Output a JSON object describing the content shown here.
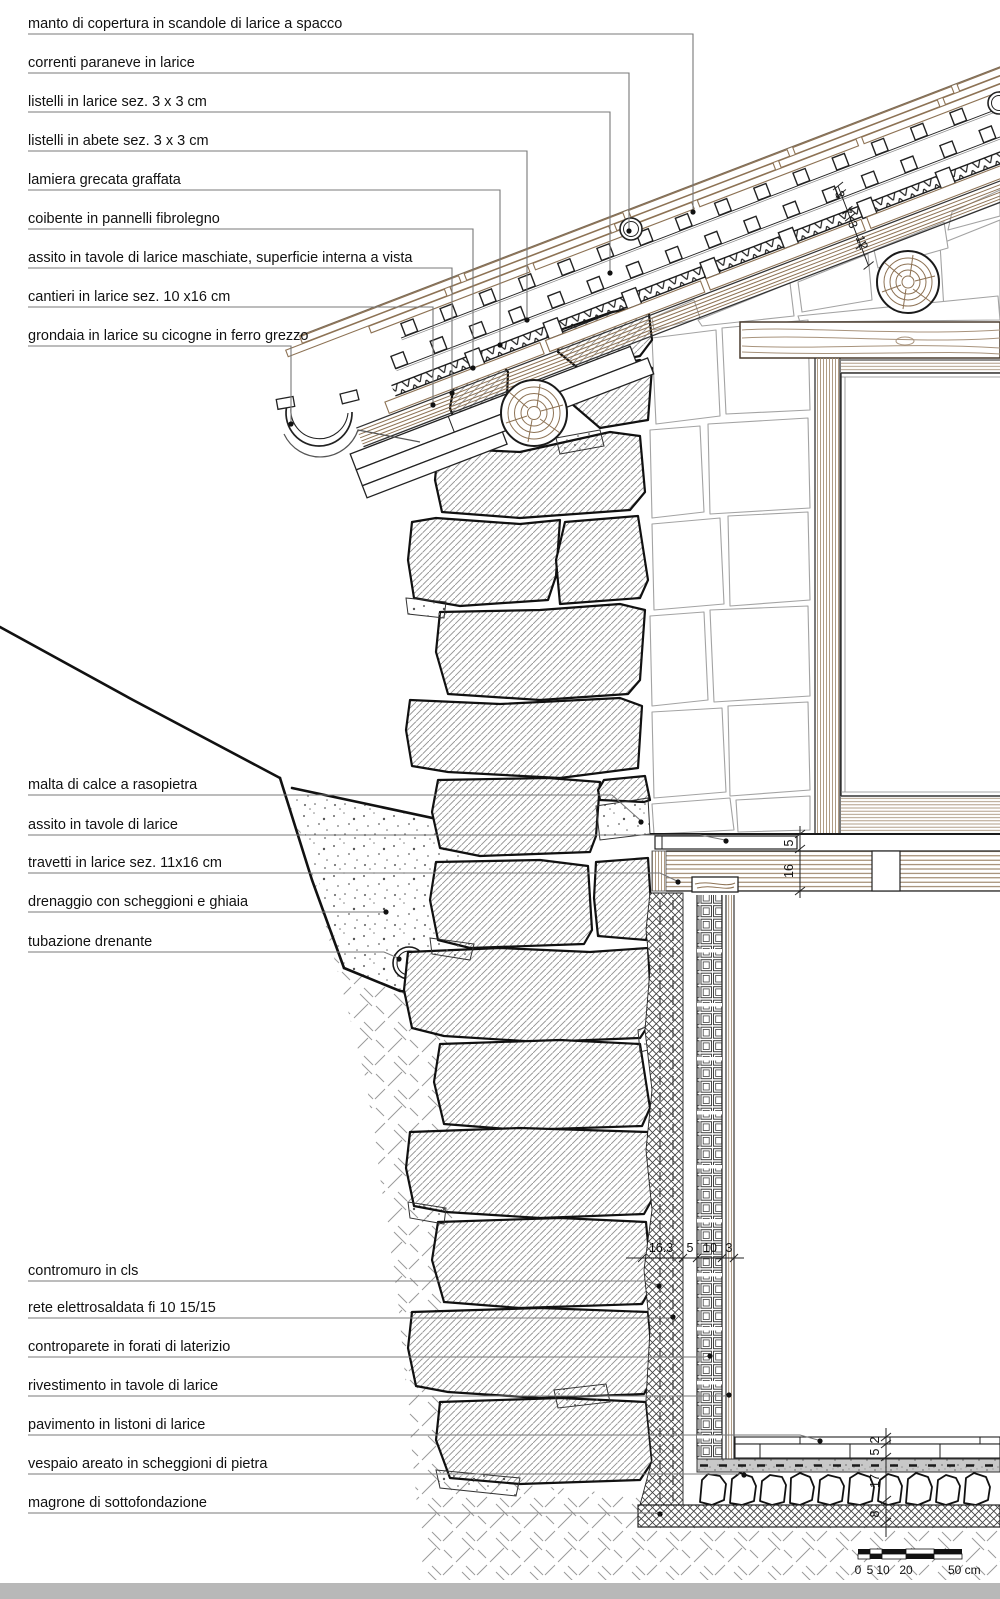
{
  "title": "Dettaglio costruttivo sezione parete-tetto-fondazione",
  "annotations": {
    "top": [
      {
        "text": "manto di copertura in scandole di larice a spacco"
      },
      {
        "text": "correnti paraneve in larice"
      },
      {
        "text": "listelli in larice sez. 3 x 3 cm"
      },
      {
        "text": "listelli in abete sez. 3 x 3 cm"
      },
      {
        "text": "lamiera grecata graffata"
      },
      {
        "text": "coibente in pannelli fibrolegno"
      },
      {
        "text": "assito in tavole di larice maschiate, superficie interna a vista"
      },
      {
        "text": "cantieri in larice  sez. 10 x16 cm"
      },
      {
        "text": "grondaia in larice su cicogne in ferro grezzo"
      }
    ],
    "middle": [
      {
        "text": "malta di calce a rasopietra"
      },
      {
        "text": "assito in tavole di larice"
      },
      {
        "text": "travetti in larice sez. 11x16 cm"
      },
      {
        "text": "drenaggio con scheggioni e ghiaia"
      },
      {
        "text": "tubazione drenante"
      }
    ],
    "bottom": [
      {
        "text": "contromuro in cls"
      },
      {
        "text": "rete elettrosaldata fi 10 15/15"
      },
      {
        "text": "controparete in forati di laterizio"
      },
      {
        "text": "rivestimento in tavole di larice"
      },
      {
        "text": "pavimento in listoni di larice"
      },
      {
        "text": "vespaio areato in scheggioni di pietra"
      },
      {
        "text": "magrone di sottofondazione"
      }
    ]
  },
  "dimensions": {
    "roof_chain": [
      "3",
      "7",
      "3",
      "12"
    ],
    "floor_upper": [
      "5",
      "16"
    ],
    "wall_chain": [
      "16.3",
      "5",
      "10",
      "3"
    ],
    "floor_lower": [
      "2",
      "5",
      "17",
      "8"
    ]
  },
  "scale_bar": {
    "t0": "0",
    "t1": "5",
    "t2": "10",
    "t3": "20",
    "t4": "50 cm"
  },
  "colors": {
    "wood": "#8d7254",
    "line": "#1a1a1a",
    "leader": "#787878",
    "hatch": "#909090",
    "grain": "#a8937c"
  }
}
